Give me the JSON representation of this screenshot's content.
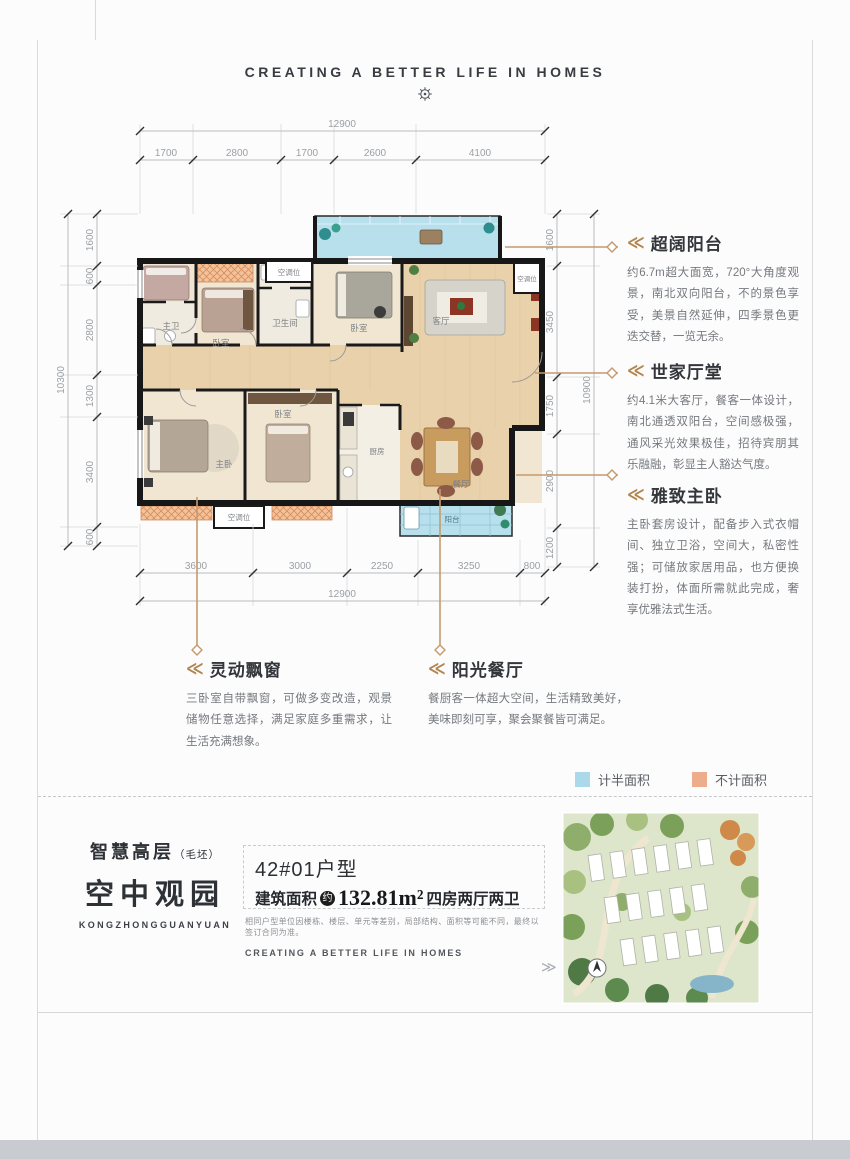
{
  "header": {
    "tagline": "CREATING A BETTER LIFE IN HOMES"
  },
  "icons": {
    "title_chevron": "≪",
    "chevron_right": "≫"
  },
  "plan": {
    "room_labels": [
      "主卫",
      "卧室",
      "卫生间",
      "空调位",
      "卧室",
      "客厅",
      "空调位",
      "主卧",
      "卧室",
      "厨房",
      "餐厅",
      "阳台",
      "空调位"
    ],
    "dims": {
      "top_total": "12900",
      "top_segments": [
        "1700",
        "2800",
        "1700",
        "2600",
        "4100"
      ],
      "left_total": "10300",
      "left_segments": [
        "1600",
        "600",
        "2800",
        "1300",
        "3400",
        "600"
      ],
      "right_total": "10900",
      "right_segments": [
        "1600",
        "3450",
        "1750",
        "2900",
        "1200"
      ],
      "bottom_total": "12900",
      "bottom_segments": [
        "3600",
        "3000",
        "2250",
        "3250",
        "800"
      ]
    }
  },
  "annotations": [
    {
      "title": "超阔阳台",
      "body": "约6.7m超大面宽，720°大角度观景，南北双向阳台，不的景色享受，美景自然延伸，四季景色更迭交替，一览无余。"
    },
    {
      "title": "世家厅堂",
      "body": "约4.1米大客厅，餐客一体设计，南北通透双阳台，空间感极强，通风采光效果极佳，招待宾朋其乐融融，彰显主人豁达气度。"
    },
    {
      "title": "雅致主卧",
      "body": "主卧套房设计，配备步入式衣帽间、独立卫浴，空间大，私密性强；可储放家居用品，也方便换装打扮，体面所需就此完成，奢享优雅法式生活。"
    },
    {
      "title": "灵动飘窗",
      "body": "三卧室自带飘窗，可做多变改造，观景储物任意选择，满足家庭多重需求，让生活充满想象。"
    },
    {
      "title": "阳光餐厅",
      "body": "餐厨客一体超大空间，生活精致美好，美味即刻可享，聚会聚餐皆可满足。"
    }
  ],
  "legend": {
    "half": {
      "label": "计半面积",
      "color": "#abd9e9"
    },
    "none": {
      "label": "不计面积",
      "color": "#edac8c"
    }
  },
  "footer": {
    "brand_title": "智慧高层",
    "brand_note": "（毛坯）",
    "brand_name": "空中观园",
    "brand_pinyin": "KONGZHONGGUANYUAN",
    "unit_title": "42#01户型",
    "area_label": "建筑面积",
    "area_circle": "约",
    "area_value": "132.81m²",
    "area_layout": "四房两厅两卫",
    "disclaimer": "相同户型单位因楼栋、楼层、单元等差别，局部结构、面积等可能不同，最终以签订合同为准。",
    "tagline": "CREATING A BETTER LIFE IN HOMES"
  }
}
